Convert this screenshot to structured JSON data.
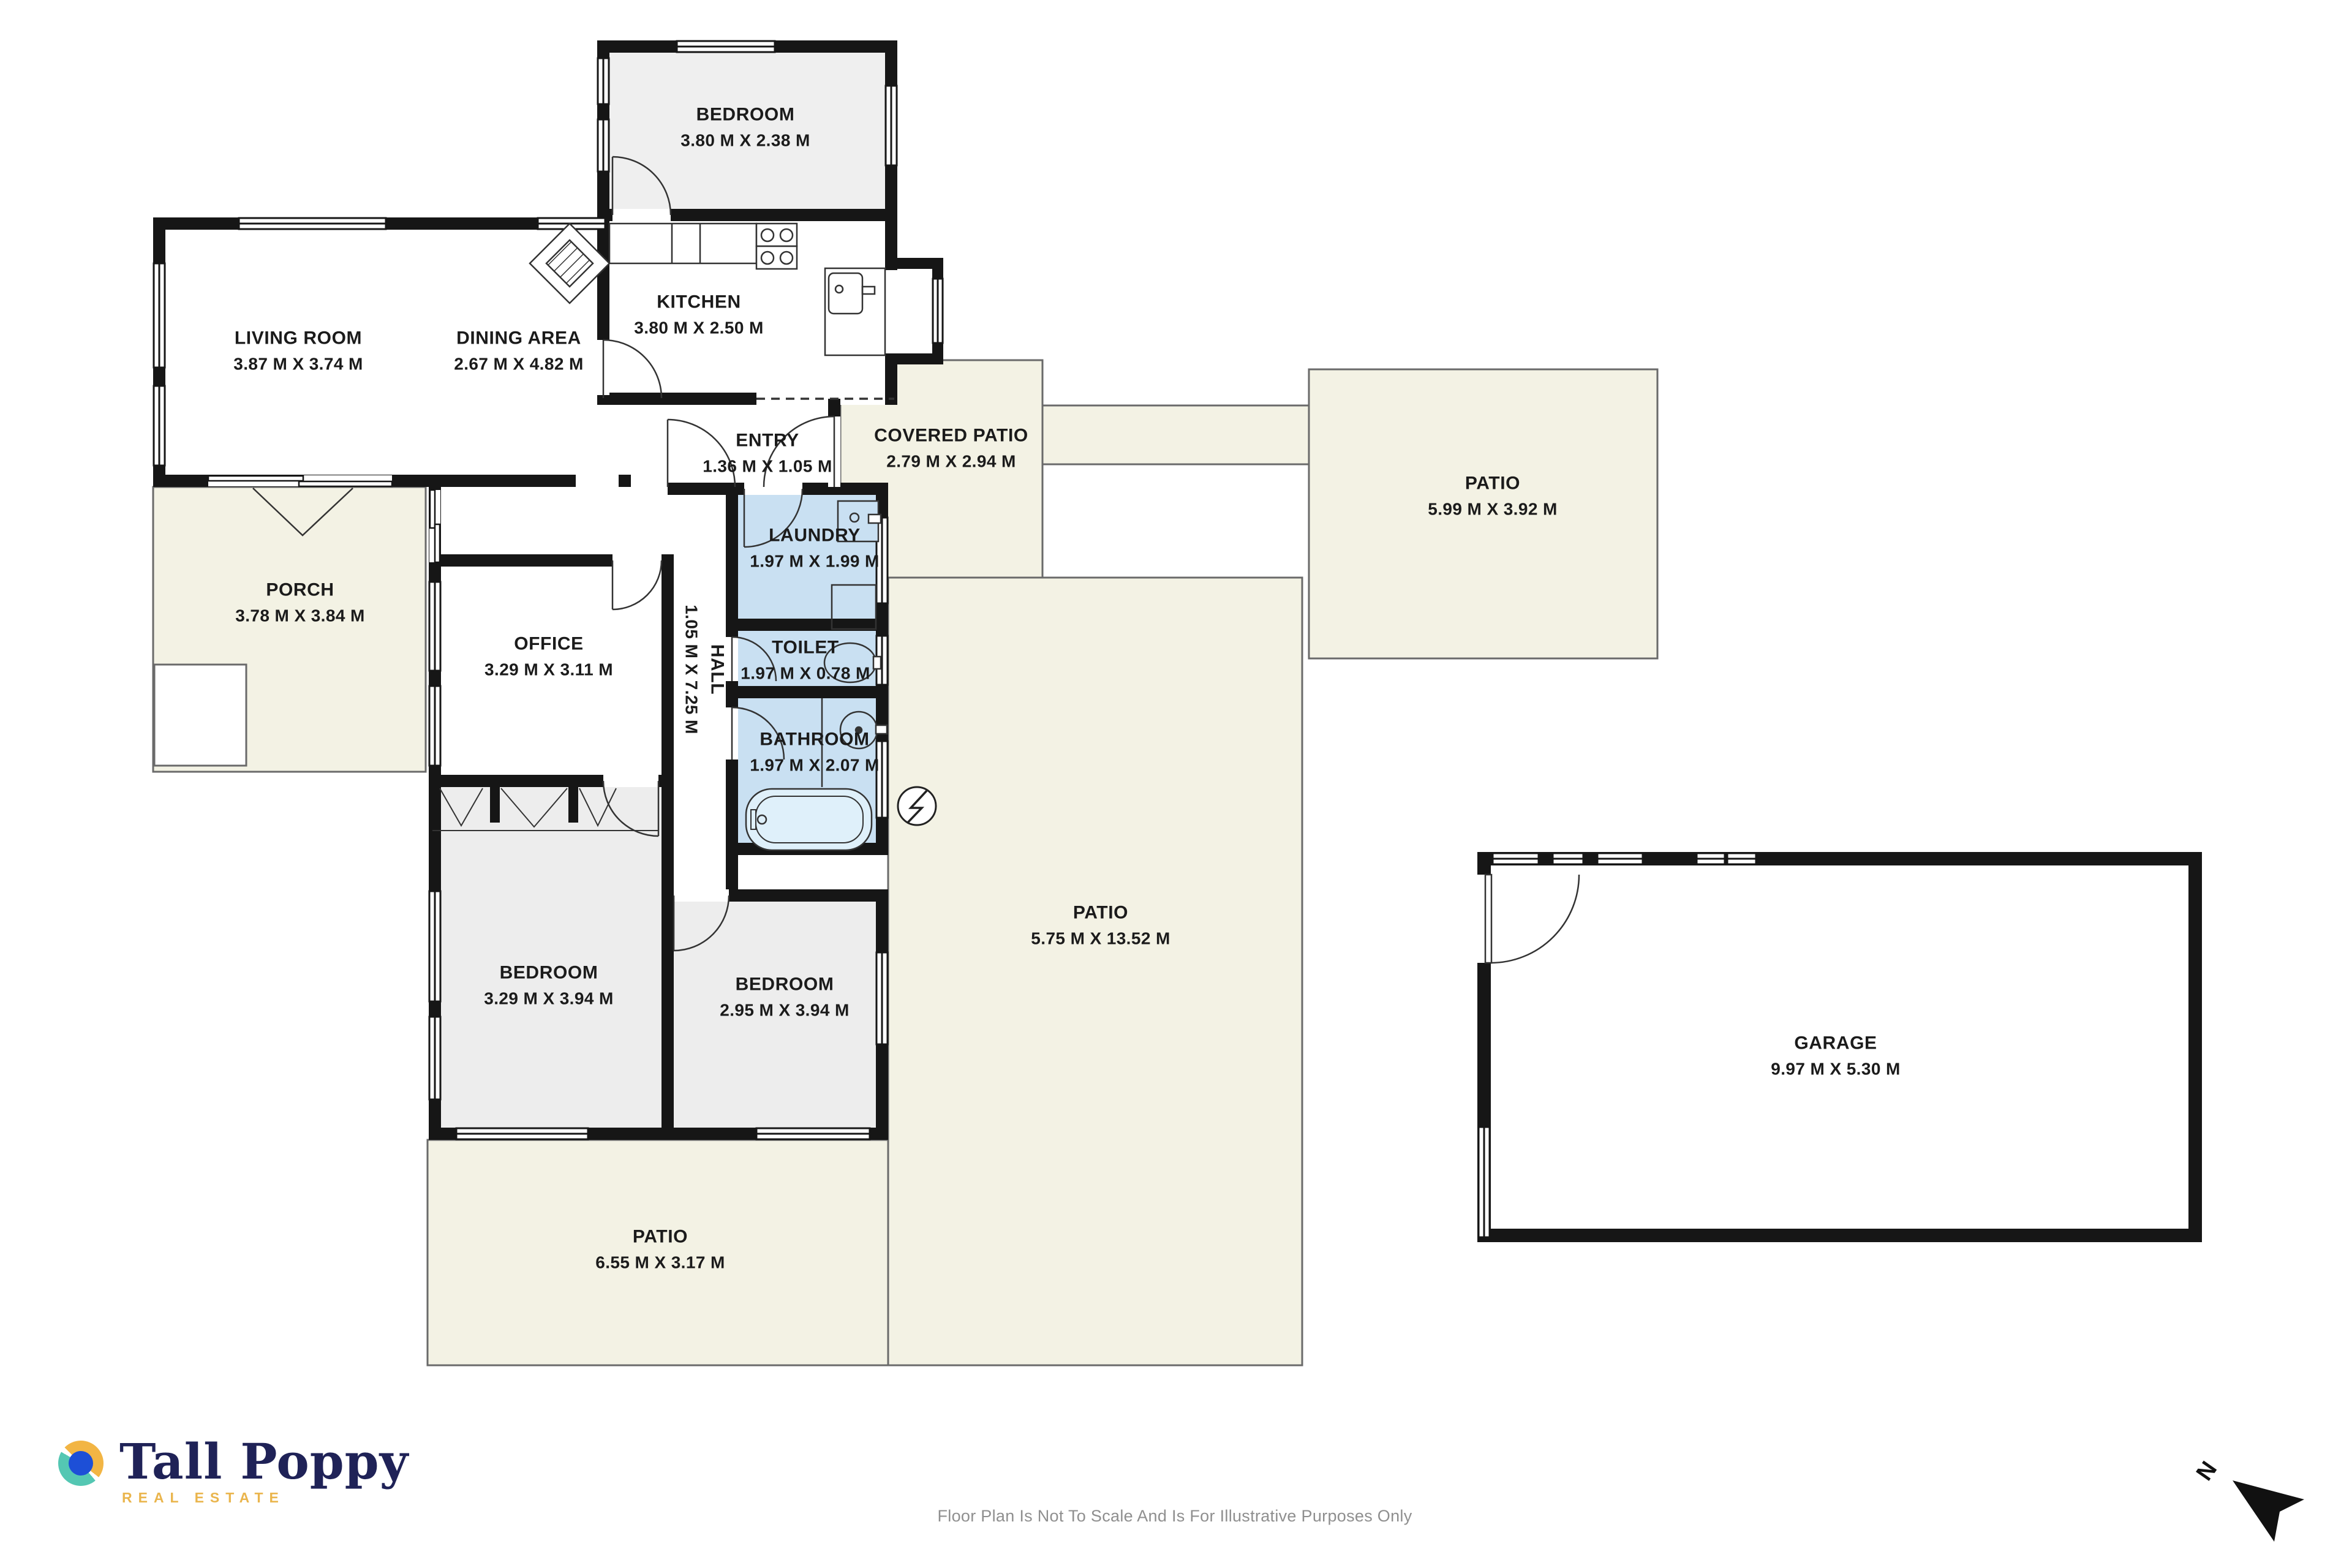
{
  "rooms": [
    {
      "id": "bedroom-top",
      "name": "BEDROOM",
      "dims": "3.80 M X 2.38 M"
    },
    {
      "id": "kitchen",
      "name": "KITCHEN",
      "dims": "3.80 M X 2.50 M"
    },
    {
      "id": "living-room",
      "name": "LIVING ROOM",
      "dims": "3.87 M X 3.74 M"
    },
    {
      "id": "dining-area",
      "name": "DINING AREA",
      "dims": "2.67 M X 4.82 M"
    },
    {
      "id": "entry",
      "name": "ENTRY",
      "dims": "1.36 M X 1.05 M"
    },
    {
      "id": "covered-patio",
      "name": "COVERED PATIO",
      "dims": "2.79 M X 2.94 M"
    },
    {
      "id": "patio-right",
      "name": "PATIO",
      "dims": "5.99 M X 3.92 M"
    },
    {
      "id": "porch",
      "name": "PORCH",
      "dims": "3.78 M X 3.84 M"
    },
    {
      "id": "office",
      "name": "OFFICE",
      "dims": "3.29 M X 3.11 M"
    },
    {
      "id": "laundry",
      "name": "LAUNDRY",
      "dims": "1.97 M X 1.99 M"
    },
    {
      "id": "hall",
      "name": "HALL",
      "dims": "1.05 M X 7.25 M"
    },
    {
      "id": "toilet",
      "name": "TOILET",
      "dims": "1.97 M X 0.78 M"
    },
    {
      "id": "bathroom",
      "name": "BATHROOM",
      "dims": "1.97 M X 2.07 M"
    },
    {
      "id": "patio-main",
      "name": "PATIO",
      "dims": "5.75 M X 13.52 M"
    },
    {
      "id": "bedroom-left",
      "name": "BEDROOM",
      "dims": "3.29 M X 3.94 M"
    },
    {
      "id": "bedroom-right",
      "name": "BEDROOM",
      "dims": "2.95 M X 3.94 M"
    },
    {
      "id": "patio-bottom",
      "name": "PATIO",
      "dims": "6.55 M X 3.17 M"
    },
    {
      "id": "garage",
      "name": "GARAGE",
      "dims": "9.97 M X 5.30 M"
    }
  ],
  "branding": {
    "logo_text": "Tall Poppy",
    "logo_subtext": "REAL ESTATE"
  },
  "footer": {
    "disclaimer": "Floor Plan Is Not To Scale And Is For Illustrative Purposes Only"
  },
  "compass": {
    "label": "N"
  },
  "colors": {
    "wall": "#161616",
    "outdoor_cream": "#f3f2e4",
    "wet_room_blue": "#c9e0f2",
    "room_grey": "#efefef",
    "logo_navy": "#1f2257",
    "logo_gold": "#eab54d",
    "logo_teal": "#54c7b3",
    "logo_yellow": "#f2b544",
    "logo_blue": "#1d4fd7",
    "footer_grey": "#8f8f8f"
  }
}
